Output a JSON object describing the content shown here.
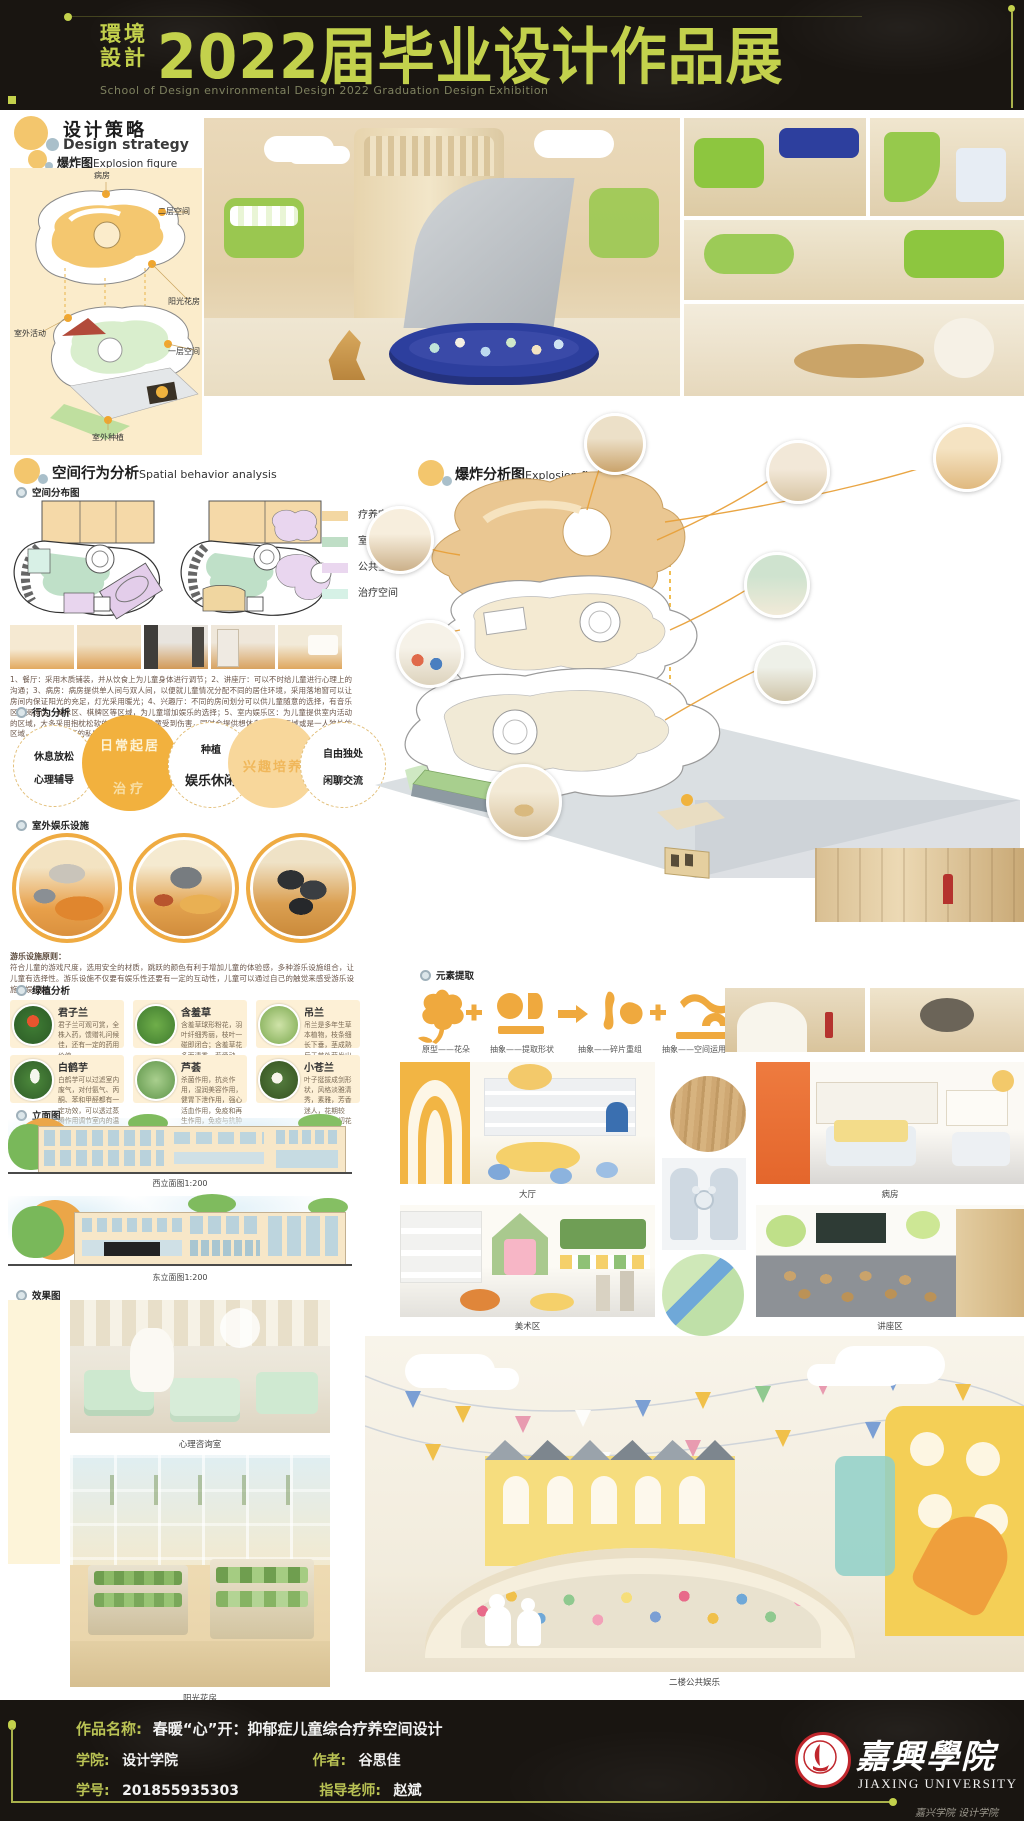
{
  "header": {
    "dept_line1": "環境",
    "dept_line2": "設計",
    "title": "2022届毕业设计作品展",
    "subtitle": "School of Design environmental Design 2022 Graduation Design Exhibition"
  },
  "design_strategy": {
    "title_cn": "设计策略",
    "title_en": "Design strategy",
    "sub_cn": "爆炸图",
    "sub_en": "Explosion figure",
    "explosion_labels": [
      "病房",
      "二层空间",
      "阳光花房",
      "室外活动",
      "一层空间",
      "室外种植"
    ]
  },
  "spatial": {
    "title_cn": "空间行为分析",
    "title_en": "Spatial behavior analysis",
    "distribution_label": "空间分布图",
    "legend": [
      {
        "label": "疗养空间",
        "color": "#f3d7a2"
      },
      {
        "label": "室外空间",
        "color": "#bfdec6"
      },
      {
        "label": "公共空间",
        "color": "#ead7ef"
      },
      {
        "label": "治疗空间",
        "color": "#d6f1e6"
      }
    ],
    "numbered_text": "1、餐厅：采用木质铺装，并从饮食上为儿童身体进行调节；2、讲座厅：可以不时给儿童进行心理上的沟通；3、病房：病房提供单人间与双人间，以便就儿童情况分配不同的居住环境，采用落地窗可以让房间内保证阳光的充足，灯光采用暖光；4、兴趣厅：不同的房间划分可以供儿童随意的选择，有音乐区、阅读区、美术区、棋牌区等区域，为儿童增加娱乐的选择；5、室内娱乐区：为儿童提供室内活动的区域，大多采用抱枕松软的材质，防止儿童受到伤害，同时会提供想休息睡觉的区域或是一人独处的区域，保证不同程度的私密性。",
    "behavior_label": "行为分析",
    "behavior_circles": [
      {
        "line1": "休息放松",
        "line2": "心理辅导"
      },
      {
        "line1": "日常起居",
        "line2": "治疗"
      },
      {
        "line1": "种植",
        "line2": "娱乐休闲"
      },
      {
        "line1": "兴趣培养",
        "line2": ""
      },
      {
        "line1": "自由独处",
        "line2": "闲聊交流"
      }
    ],
    "outdoor_label": "室外娱乐设施",
    "principle_title": "游乐设施原则：",
    "principle_text": "符合儿童的游戏尺度，选用安全的材质，跳跃的颜色有利于增加儿童的体验感，多种游乐设施组合，让儿童有选择性。游乐设施不仅要有娱乐性还要有一定的互动性，儿童可以通过自己的触觉来感受游乐设施的娱乐性。"
  },
  "plants": {
    "label": "绿植分析",
    "items": [
      {
        "name": "君子兰",
        "desc": "君子兰可观可赏，全株入药，馈赠礼问候佳，还有一定的药用价值"
      },
      {
        "name": "含羞草",
        "desc": "含羞草球形粉花，羽叶纤细秀丽，枝叶一碰即闭合；含羞草花多而清秀，惹爱动人，给人以无限温柔的印象"
      },
      {
        "name": "吊兰",
        "desc": "吊兰是多年生草本植物，枝条细长下垂，茎成熟后于节处萌发出小白花，垂下来的枝条末端，花蕊呈黄色"
      },
      {
        "name": "白鹤芋",
        "desc": "白鹤芋可以过滤室内废气，对付氨气、丙酮、苯和甲醛都有一定功效，可以透过蒸腾作用调节室内的温度和湿度"
      },
      {
        "name": "芦荟",
        "desc": "杀菌作用，抗炎作用，湿润美容作用，健胃下泄作用，强心活血作用，免疫和再生作用，免疫与抗肿瘤作用，解毒作用"
      },
      {
        "name": "小苍兰",
        "desc": "叶子挺拔成剑形状，风格淡雅清秀，素雅，芳香迷人，花期较长，常用于切花"
      }
    ]
  },
  "elevations": {
    "label": "立面图",
    "west_caption": "西立面图1:200",
    "east_caption": "东立面图1:200"
  },
  "renders_label": "效果图",
  "explosion_analysis": {
    "title_cn": "爆炸分析图",
    "title_en": "Explosion figure"
  },
  "elements": {
    "label": "元素提取",
    "steps": [
      "原型——花朵",
      "抽象——提取形状",
      "抽象——碎片重组",
      "抽象——空间运用"
    ]
  },
  "captions": {
    "lobby": "大厅",
    "ward": "病房",
    "art": "美术区",
    "lecture": "讲座区",
    "counsel": "心理咨询室",
    "sunroom": "阳光花房",
    "play": "二楼公共娱乐"
  },
  "footer": {
    "work_label": "作品名称:",
    "work_value": "春暖“心”开：抑郁症儿童综合疗养空间设计",
    "college_label": "学院:",
    "college_value": "设计学院",
    "author_label": "作者:",
    "author_value": "谷思佳",
    "sid_label": "学号:",
    "sid_value": "201855935303",
    "advisor_label": "指导老师:",
    "advisor_value": "赵斌",
    "univ_cn": "嘉興學院",
    "univ_en": "JIAXING UNIVERSITY",
    "watermark": "嘉兴学院 设计学院"
  },
  "colors": {
    "accent": "#c3d14c",
    "bar_bg": "#191511",
    "cream_panel": "#fbeccb",
    "circle_orange": "#f2b13e",
    "circle_light": "#f8d79b",
    "element_orange": "#efa93e"
  }
}
